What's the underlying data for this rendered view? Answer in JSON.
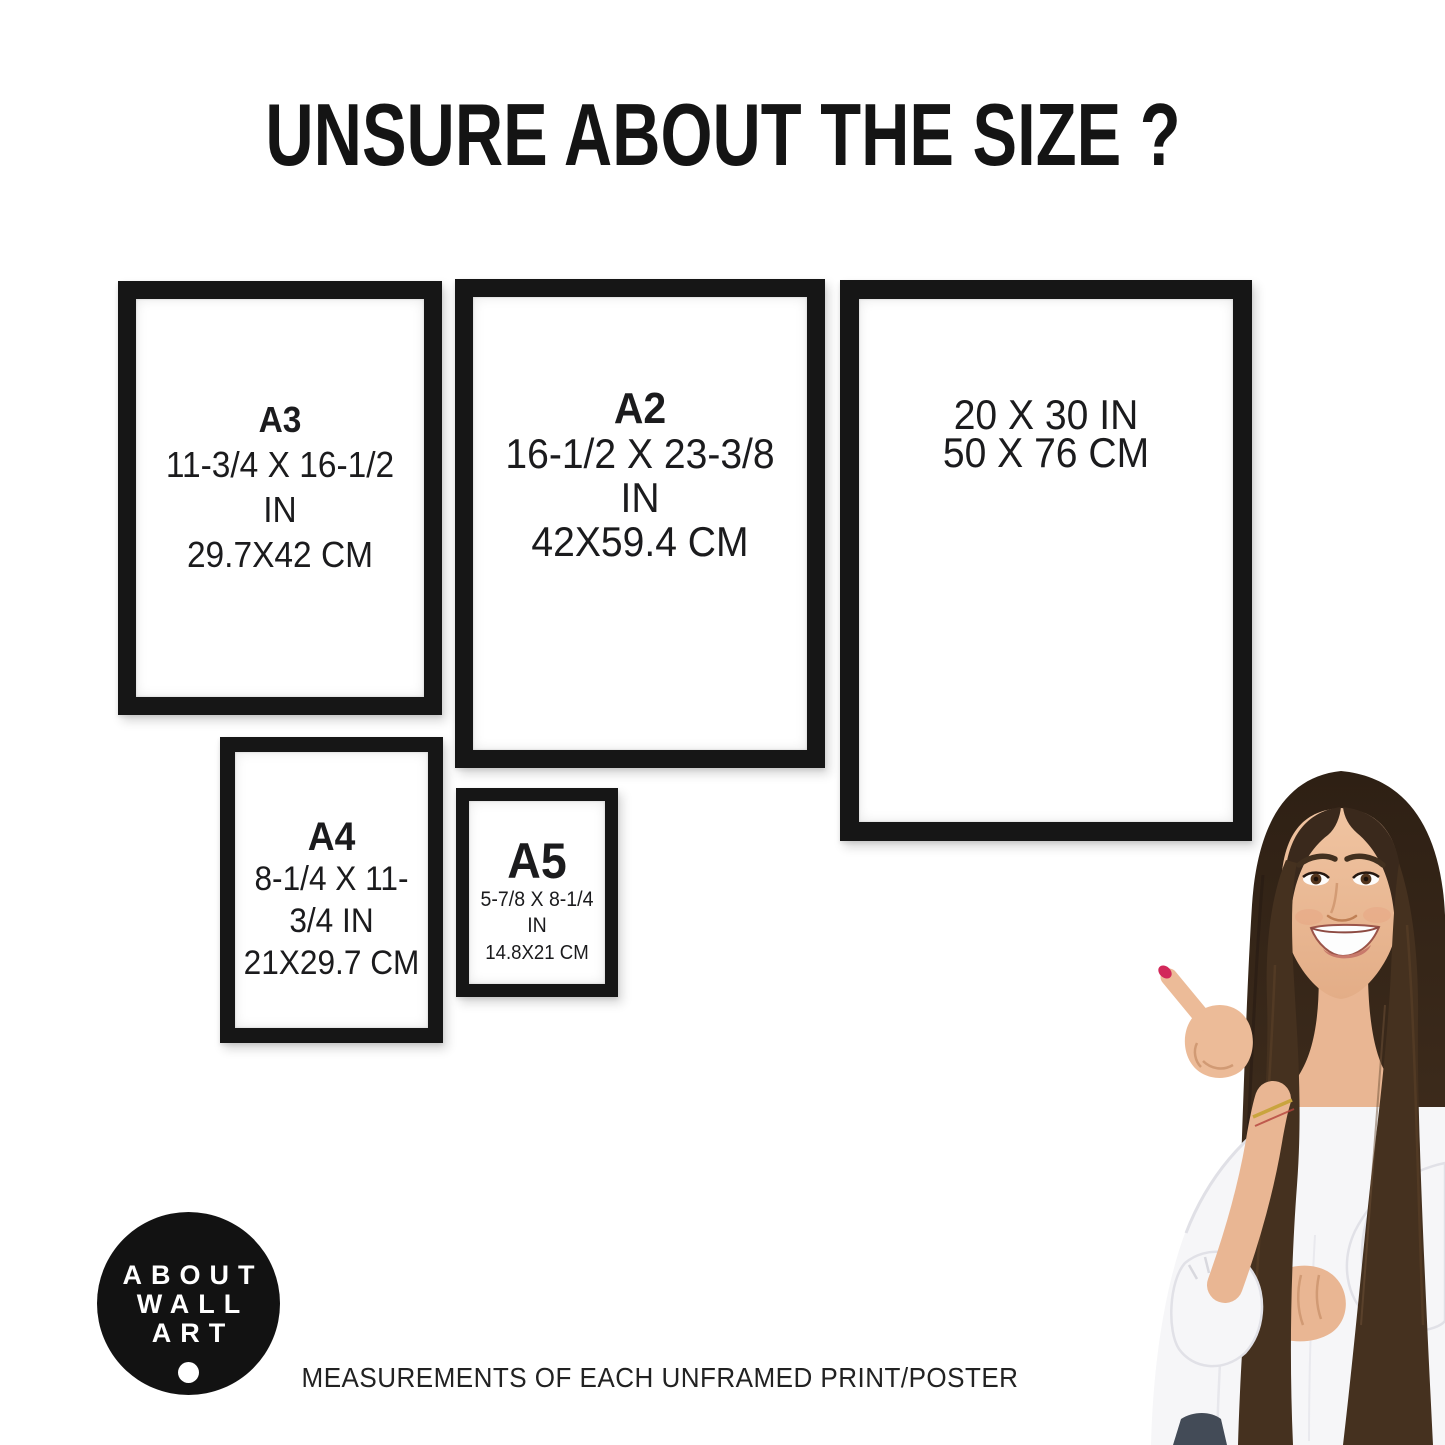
{
  "title": "UNSURE ABOUT THE SIZE ?",
  "frames": [
    {
      "label": "A3",
      "inches": "11-3/4 X 16-1/2 IN",
      "cm": "29.7X42 CM"
    },
    {
      "label": "A2",
      "inches": "16-1/2 X 23-3/8 IN",
      "cm": "42X59.4 CM"
    },
    {
      "label": "",
      "inches": "20 X 30 IN",
      "cm": "50 X 76 CM"
    },
    {
      "label": "A4",
      "inches": "8-1/4 X 11-3/4 IN",
      "cm": "21X29.7 CM"
    },
    {
      "label": "A5",
      "inches": "5-7/8 X 8-1/4 IN",
      "cm": "14.8X21 CM"
    }
  ],
  "logo": {
    "lines": [
      "ABOUT",
      "WALL",
      "ART"
    ]
  },
  "caption": "MEASUREMENTS OF EACH UNFRAMED PRINT/POSTER",
  "colors": {
    "frame": "#161616",
    "text": "#1b1b1d",
    "logo_bg": "#121212",
    "logo_text": "#ffffff",
    "nail": "#d2285a",
    "hair": "#3a291c",
    "blouse": "#f6f6f8"
  }
}
